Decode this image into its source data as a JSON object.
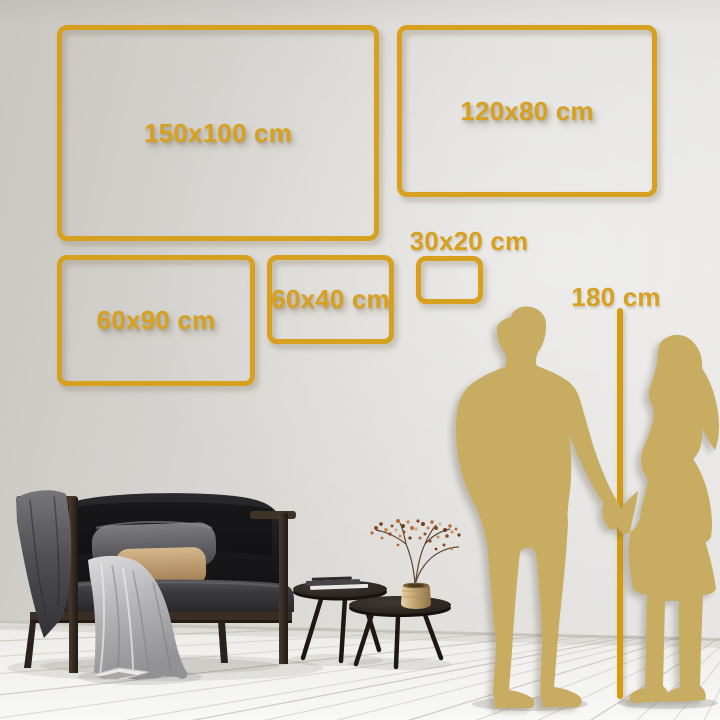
{
  "frames": [
    {
      "id": "150x100",
      "label": "150x100 cm"
    },
    {
      "id": "120x80",
      "label": "120x80 cm"
    },
    {
      "id": "60x90",
      "label": "60x90 cm"
    },
    {
      "id": "60x40",
      "label": "60x40 cm"
    },
    {
      "id": "30x20",
      "label": "30x20 cm"
    }
  ],
  "height_reference": {
    "label": "180 cm"
  },
  "colors": {
    "frame_gold": "#D7A01F",
    "height_line": "#D59B13",
    "silhouette_gold": "#C8AC62",
    "wall": "#DCDAD6",
    "floor": "#F4F3F1"
  },
  "scene": {
    "silhouettes": [
      "man",
      "woman"
    ],
    "furniture": [
      "sofa",
      "blanket",
      "pillows",
      "coffee-table-tall",
      "coffee-table-low",
      "vase-plant",
      "books"
    ]
  }
}
